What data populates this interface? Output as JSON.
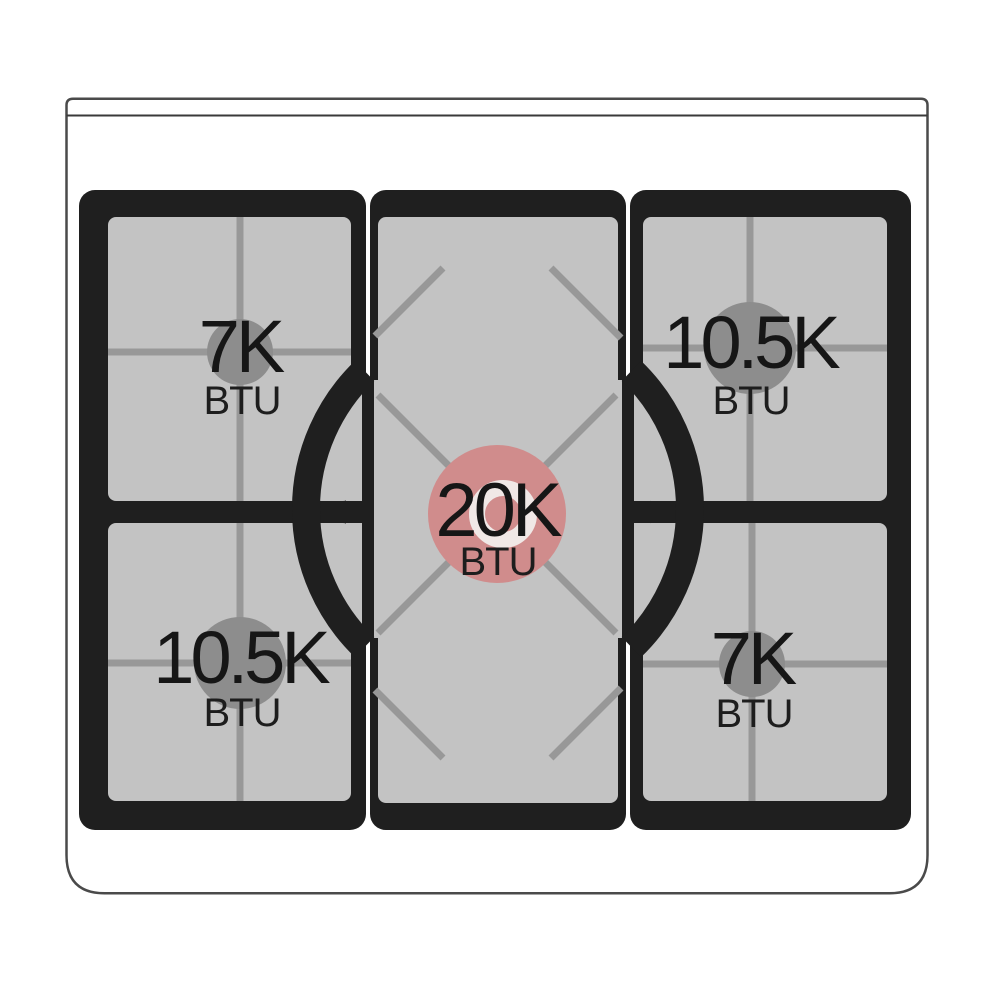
{
  "cooktop": {
    "burners": [
      {
        "position": "top-left",
        "rating": "7K",
        "unit": "BTU"
      },
      {
        "position": "top-right",
        "rating": "10.5K",
        "unit": "BTU"
      },
      {
        "position": "center",
        "rating": "20K",
        "unit": "BTU",
        "highlighted": true
      },
      {
        "position": "bottom-left",
        "rating": "10.5K",
        "unit": "BTU"
      },
      {
        "position": "bottom-right",
        "rating": "7K",
        "unit": "BTU"
      }
    ]
  },
  "colors": {
    "center_burner_highlight": "#d08c8c",
    "center_burner_inner_ring": "#f0e8e6",
    "plate_black": "#1f1f1f",
    "panel_gray": "#c3c3c3",
    "grid_line_gray": "#989898",
    "burner_cap_gray": "#8d8d8d"
  }
}
